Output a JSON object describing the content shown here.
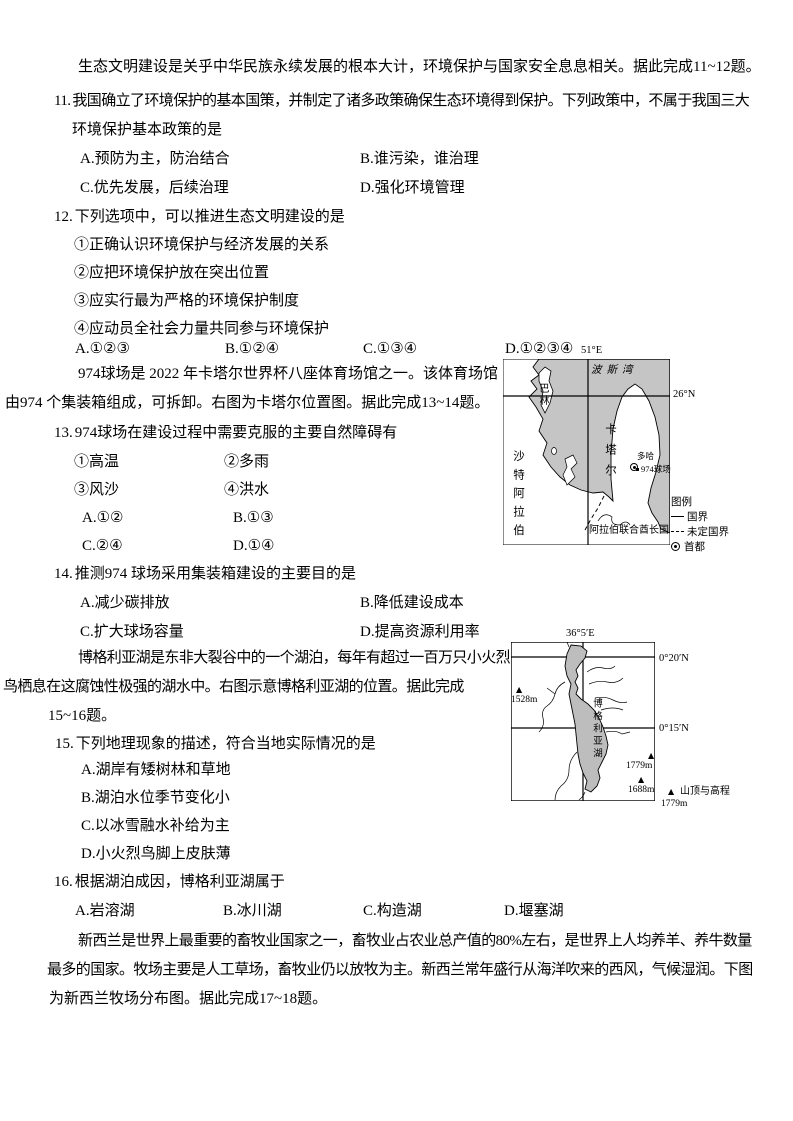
{
  "page": {
    "background": "#ffffff",
    "text_color": "#000000"
  },
  "eco": {
    "intro": "生态文明建设是关乎中华民族永续发展的根本大计，环境保护与国家安全息息相关。据此完成11~12题。",
    "q11": {
      "num": "11.",
      "line1": "我国确立了环境保护的基本国策，并制定了诸多政策确保生态环境得到保护。下列政策中，不属于我国三大",
      "line2": "环境保护基本政策的是",
      "opts": [
        "A.预防为主，防治结合",
        "B.谁污染，谁治理",
        "C.优先发展，后续治理",
        "D.强化环境管理"
      ]
    },
    "q12": {
      "num": "12.",
      "stem": "下列选项中，可以推进生态文明建设的是",
      "items": [
        "①正确认识环境保护与经济发展的关系",
        "②应把环境保护放在突出位置",
        "③应实行最为严格的环境保护制度",
        "④应动员全社会力量共同参与环境保护"
      ],
      "opts": [
        "A.①②③",
        "B.①②④",
        "C.①③④",
        "D.①②③④"
      ]
    }
  },
  "qatar": {
    "intro_line1": "974球场是 2022 年卡塔尔世界杯八座体育场馆之一。该体育场馆",
    "intro_line2": "由974 个集装箱组成，可拆卸。右图为卡塔尔位置图。据此完成13~14题。",
    "q13": {
      "num": "13.",
      "stem": "974球场在建设过程中需要克服的主要自然障碍有",
      "items": [
        "①高温",
        "②多雨",
        "③风沙",
        "④洪水"
      ],
      "opts": [
        "A.①②",
        "B.①③",
        "C.②④",
        "D.①④"
      ]
    },
    "q14": {
      "num": "14.",
      "stem": "推测974 球场采用集装箱建设的主要目的是",
      "opts": [
        "A.减少碳排放",
        "B.降低建设成本",
        "C.扩大球场容量",
        "D.提高资源利用率"
      ]
    },
    "map": {
      "lon": "51°E",
      "lat": "26°N",
      "sea_name": "波斯湾",
      "bahrain": "巴林",
      "qatar": "卡塔尔",
      "saudi": "沙特阿拉伯",
      "uae": "阿拉伯联合酋长国",
      "doha": "多哈",
      "stadium": "974球场",
      "legend_title": "图例",
      "legend_border": "国界",
      "legend_undefined_border": "未定国界",
      "legend_capital": "首都",
      "sea_color": "#c5c5c5",
      "land_color": "#ffffff"
    }
  },
  "bogoria": {
    "intro_line1": "博格利亚湖是东非大裂谷中的一个湖泊，每年有超过一百万只小火烈",
    "intro_line2": "鸟栖息在这腐蚀性极强的湖水中。右图示意博格利亚湖的位置。据此完成",
    "intro_line3": "15~16题。",
    "q15": {
      "num": "15.",
      "stem": "下列地理现象的描述，符合当地实际情况的是",
      "opts": [
        "A.湖岸有矮树林和草地",
        "B.湖泊水位季节变化小",
        "C.以冰雪融水补给为主",
        "D.小火烈鸟脚上皮肤薄"
      ]
    },
    "q16": {
      "num": "16.",
      "stem": "根据湖泊成因，博格利亚湖属于",
      "opts": [
        "A.岩溶湖",
        "B.冰川湖",
        "C.构造湖",
        "D.堰塞湖"
      ]
    },
    "map": {
      "lon": "36°5′E",
      "lat_upper": "0°20′N",
      "lat_lower": "0°15′N",
      "lake_name": "博格利亚湖",
      "peak_icon": "▲",
      "peak_west": "1528m",
      "peak_east": "1779m",
      "peak_south": "1688m",
      "legend_peak_value": "1779m",
      "legend_peak_label": "山顶与高程",
      "lake_color": "#bdbdbd"
    }
  },
  "nz": {
    "intro_line1": "新西兰是世界上最重要的畜牧业国家之一，畜牧业占农业总产值的80%左右，是世界上人均养羊、养牛数量",
    "intro_line2": "最多的国家。牧场主要是人工草场，畜牧业仍以放牧为主。新西兰常年盛行从海洋吹来的西风，气候湿润。下图",
    "intro_line3": "为新西兰牧场分布图。据此完成17~18题。"
  }
}
